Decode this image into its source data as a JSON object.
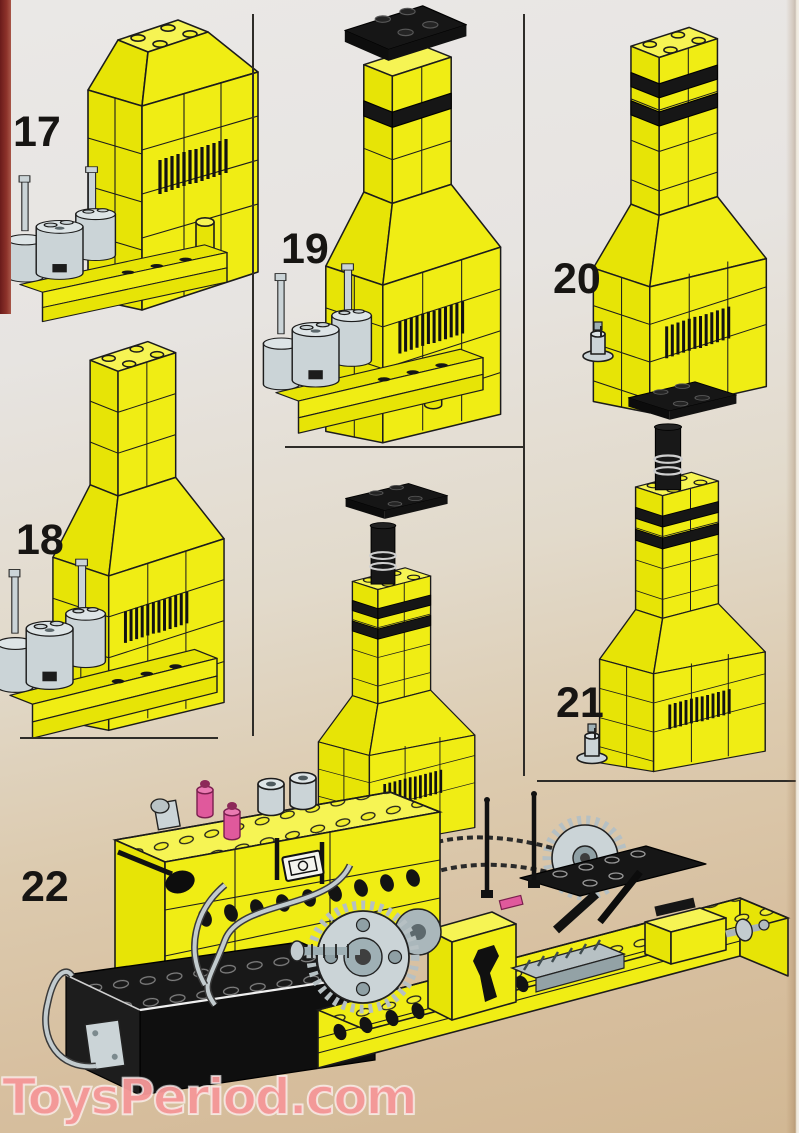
{
  "document": {
    "kind": "lego-building-instructions-scan"
  },
  "steps": [
    {
      "number": "17",
      "figure": "yellow boiler housing with vent grille and grey steam domes on studded base"
    },
    {
      "number": "18",
      "figure": "boiler housing with tall chimney neck, vent grille and grey steam domes"
    },
    {
      "number": "19",
      "figure": "chimney with black cap plate and black stripe band on boiler housing"
    },
    {
      "number": "20",
      "figure": "free-standing chimney stack with two black bands, vent grille and grey valve"
    },
    {
      "number": "21",
      "figure": "chimney stack with black chimney-pot finial, two black bands and grey valve"
    },
    {
      "number": "22",
      "figure": "complete boiler unit with striped chimney, battery box with cable, gear train, chain drive and studded base plate"
    }
  ],
  "watermark": {
    "text": "ToysPeriod.com",
    "color": "#f39294"
  },
  "palette": {
    "brick_yellow": "#f0ed14",
    "part_grey": "#cbd4d7",
    "part_black": "#161616",
    "part_pink": "#e0599c",
    "page_top": "#eae8e6",
    "page_bottom": "#d2b894",
    "spine_red": "#8d322a",
    "rule_color": "#2e2c28"
  }
}
